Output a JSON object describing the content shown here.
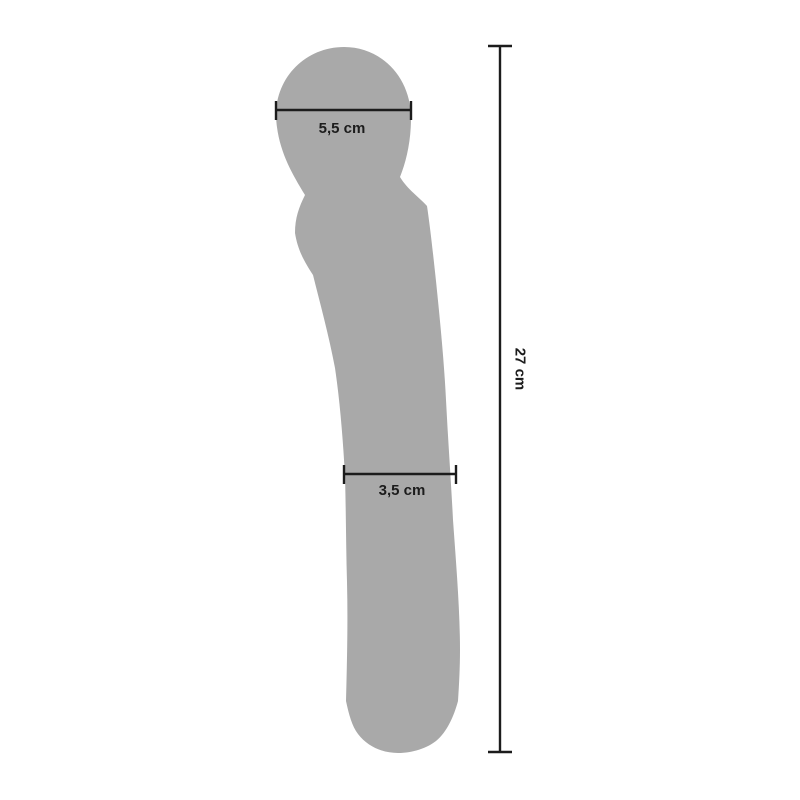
{
  "diagram": {
    "type": "product-dimension-diagram",
    "product": "wand-massager-silhouette",
    "background_color": "#ffffff",
    "silhouette_color": "#a9a9a9",
    "line_color": "#1c1c1c",
    "measurements": {
      "head_width": {
        "label": "5,5 cm",
        "value": 5.5,
        "unit": "cm"
      },
      "shaft_width": {
        "label": "3,5 cm",
        "value": 3.5,
        "unit": "cm"
      },
      "total_length": {
        "label": "27 cm",
        "value": 27,
        "unit": "cm"
      }
    }
  }
}
